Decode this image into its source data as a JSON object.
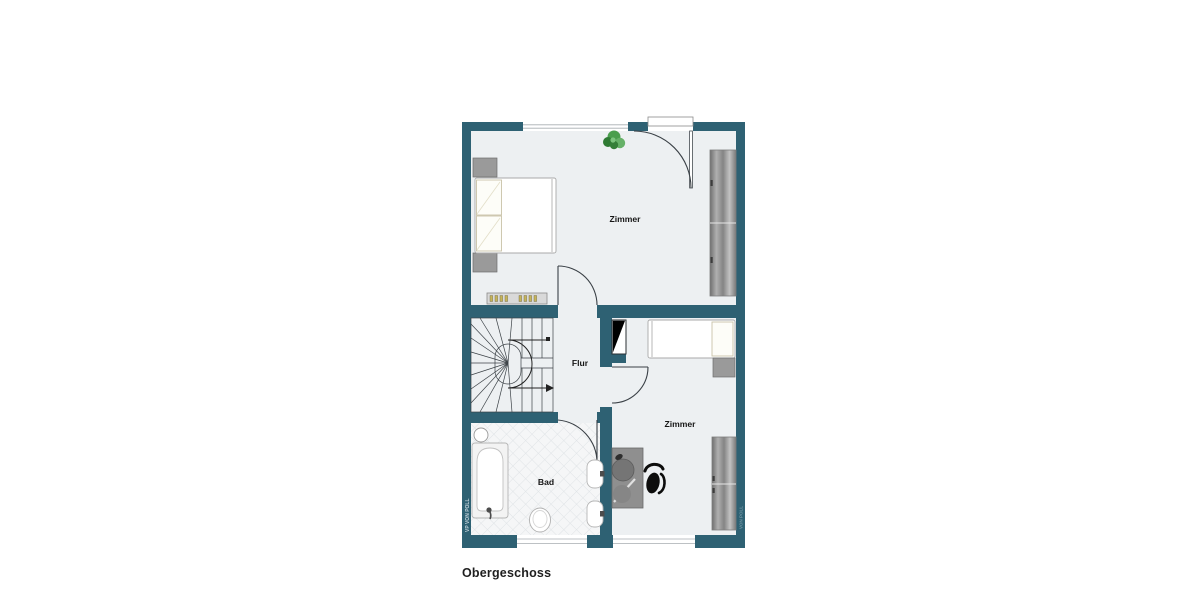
{
  "floorplan": {
    "caption": "Obergeschoss",
    "rooms": {
      "zimmer_top": "Zimmer",
      "flur": "Flur",
      "zimmer_bottom": "Zimmer",
      "bad": "Bad"
    },
    "watermark_left": "VP VON POLL",
    "watermark_right": "VON POLL",
    "colors": {
      "wall": "#2e6173",
      "floor": "#edf0f2",
      "tile_line": "#dfe3e6",
      "furniture_gray": "#9a9a9a",
      "wardrobe_gray": "#8d8d8d",
      "plant_green": "#3e8e41",
      "radiator_fin": "#c7b45a",
      "line": "#3a4046",
      "background": "#ffffff",
      "label_text": "#161616"
    }
  }
}
